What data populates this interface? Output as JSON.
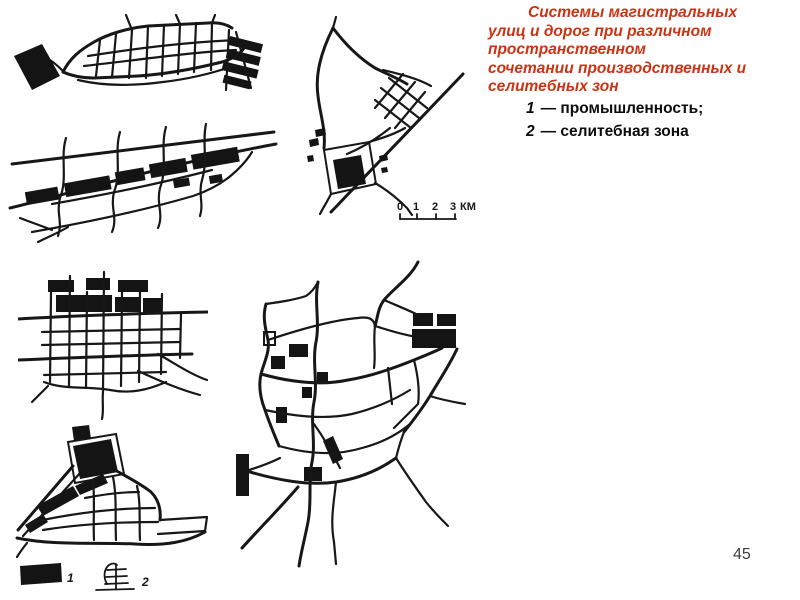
{
  "slide": {
    "background": "#ffffff",
    "page_number": "45"
  },
  "title": {
    "color": "#cc3312",
    "lines": [
      "Системы магистральных",
      "улиц и дорог при различном",
      "пространственном",
      "сочетании производственных и",
      "селитебных зон"
    ]
  },
  "legend": {
    "items": [
      {
        "num": "1",
        "text": "— промышленность;"
      },
      {
        "num": "2",
        "text": "— селитебная зона"
      }
    ]
  },
  "scale_bar": {
    "ticks": [
      "0",
      "1",
      "2",
      "3"
    ],
    "unit": "КМ"
  },
  "map_key": {
    "industry": {
      "num": "1",
      "symbol": "filled-black-rectangle"
    },
    "residential": {
      "num": "2",
      "symbol": "street-grid-sketch"
    }
  },
  "figure": {
    "ink": "#171717",
    "maps": [
      {
        "name": "linear-city-map"
      },
      {
        "name": "industrial-band-city-map"
      },
      {
        "name": "compact-diagonal-city-map"
      },
      {
        "name": "grid-city-map"
      },
      {
        "name": "triangular-city-map"
      },
      {
        "name": "sprawling-city-map"
      }
    ]
  }
}
